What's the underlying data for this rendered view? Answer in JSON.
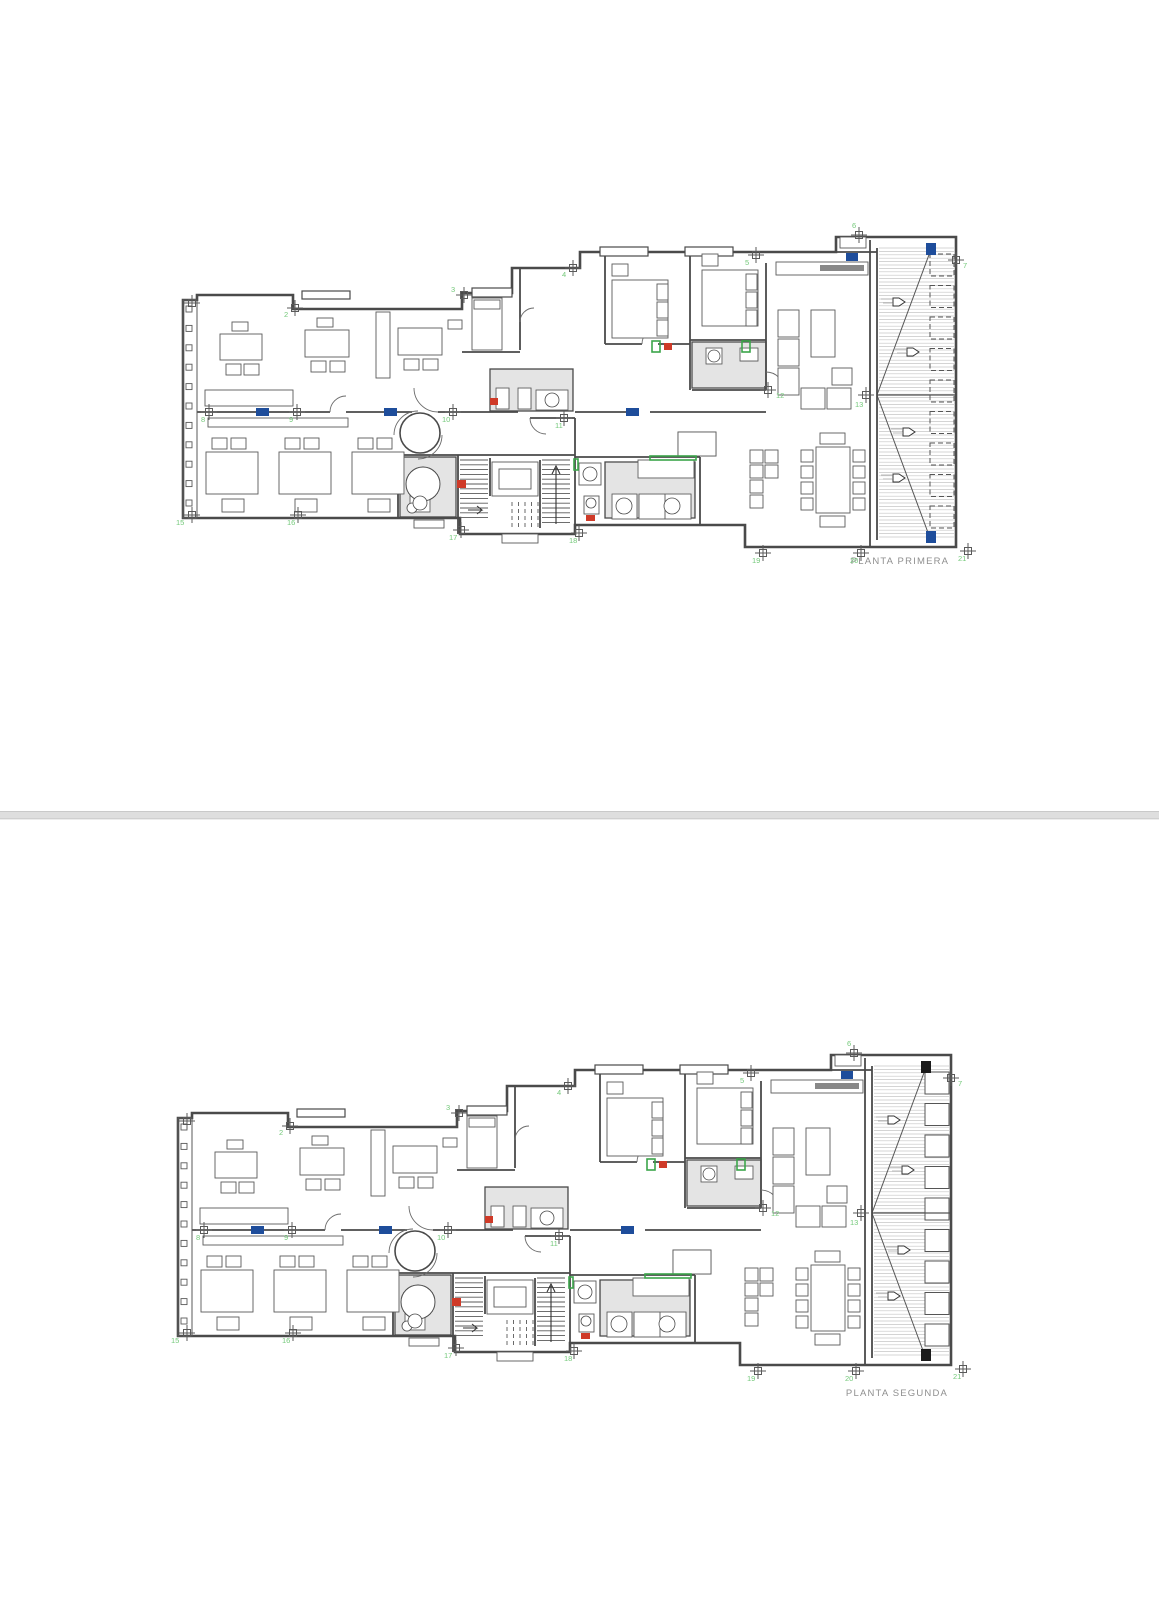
{
  "document": {
    "type": "architectural-floor-plans",
    "sheet_count": 2
  },
  "colors": {
    "wall": "#4a4a4a",
    "thin": "#5a5a5a",
    "marker_green": "#74c97a",
    "accent_blue": "#1e4d9b",
    "accent_red": "#cf3a28",
    "accent_green": "#3ba54a",
    "hatch_line": "#c2c2c2",
    "deck_line": "#c6c6c6",
    "title_gray": "#8f8f8f",
    "page_divider": "#dedede"
  },
  "plans": [
    {
      "id": "primera",
      "title": "PLANTA PRIMERA",
      "terrace_slat_style": "dashed",
      "corner_block_color": "#1e4d9b",
      "markers": [
        {
          "label": "",
          "x": 12,
          "y": 81,
          "lx": 0,
          "ly": 0
        },
        {
          "label": "2",
          "x": 115,
          "y": 86,
          "lx": 104,
          "ly": 95
        },
        {
          "label": "3",
          "x": 284,
          "y": 73,
          "lx": 271,
          "ly": 70
        },
        {
          "label": "4",
          "x": 393,
          "y": 46,
          "lx": 382,
          "ly": 55
        },
        {
          "label": "5",
          "x": 576,
          "y": 33,
          "lx": 565,
          "ly": 43
        },
        {
          "label": "6",
          "x": 679,
          "y": 13,
          "lx": 672,
          "ly": 6
        },
        {
          "label": "7",
          "x": 776,
          "y": 38,
          "lx": 783,
          "ly": 46
        },
        {
          "label": "8",
          "x": 29,
          "y": 190,
          "lx": 21,
          "ly": 200
        },
        {
          "label": "9",
          "x": 117,
          "y": 190,
          "lx": 109,
          "ly": 200
        },
        {
          "label": "10",
          "x": 273,
          "y": 190,
          "lx": 262,
          "ly": 200
        },
        {
          "label": "11",
          "x": 384,
          "y": 196,
          "lx": 375,
          "ly": 206
        },
        {
          "label": "12",
          "x": 588,
          "y": 168,
          "lx": 596,
          "ly": 176
        },
        {
          "label": "13",
          "x": 686,
          "y": 173,
          "lx": 675,
          "ly": 185
        },
        {
          "label": "15",
          "x": 12,
          "y": 293,
          "lx": -4,
          "ly": 303
        },
        {
          "label": "16",
          "x": 118,
          "y": 293,
          "lx": 107,
          "ly": 303
        },
        {
          "label": "17",
          "x": 281,
          "y": 308,
          "lx": 269,
          "ly": 318
        },
        {
          "label": "18",
          "x": 399,
          "y": 311,
          "lx": 389,
          "ly": 321
        },
        {
          "label": "19",
          "x": 583,
          "y": 331,
          "lx": 572,
          "ly": 341
        },
        {
          "label": "20",
          "x": 681,
          "y": 331,
          "lx": 670,
          "ly": 341
        },
        {
          "label": "21",
          "x": 788,
          "y": 329,
          "lx": 778,
          "ly": 339
        }
      ]
    },
    {
      "id": "segunda",
      "title": "PLANTA SEGUNDA",
      "terrace_slat_style": "solid",
      "corner_block_color": "#1b1b1b",
      "markers": [
        {
          "label": "",
          "x": 12,
          "y": 81,
          "lx": 0,
          "ly": 0
        },
        {
          "label": "2",
          "x": 115,
          "y": 86,
          "lx": 104,
          "ly": 95
        },
        {
          "label": "3",
          "x": 284,
          "y": 73,
          "lx": 271,
          "ly": 70
        },
        {
          "label": "4",
          "x": 393,
          "y": 46,
          "lx": 382,
          "ly": 55
        },
        {
          "label": "5",
          "x": 576,
          "y": 33,
          "lx": 565,
          "ly": 43
        },
        {
          "label": "6",
          "x": 679,
          "y": 13,
          "lx": 672,
          "ly": 6
        },
        {
          "label": "7",
          "x": 776,
          "y": 38,
          "lx": 783,
          "ly": 46
        },
        {
          "label": "8",
          "x": 29,
          "y": 190,
          "lx": 21,
          "ly": 200
        },
        {
          "label": "9",
          "x": 117,
          "y": 190,
          "lx": 109,
          "ly": 200
        },
        {
          "label": "10",
          "x": 273,
          "y": 190,
          "lx": 262,
          "ly": 200
        },
        {
          "label": "11",
          "x": 384,
          "y": 196,
          "lx": 375,
          "ly": 206
        },
        {
          "label": "12",
          "x": 588,
          "y": 168,
          "lx": 596,
          "ly": 176
        },
        {
          "label": "13",
          "x": 686,
          "y": 173,
          "lx": 675,
          "ly": 185
        },
        {
          "label": "15",
          "x": 12,
          "y": 293,
          "lx": -4,
          "ly": 303
        },
        {
          "label": "16",
          "x": 118,
          "y": 293,
          "lx": 107,
          "ly": 303
        },
        {
          "label": "17",
          "x": 281,
          "y": 308,
          "lx": 269,
          "ly": 318
        },
        {
          "label": "18",
          "x": 399,
          "y": 311,
          "lx": 389,
          "ly": 321
        },
        {
          "label": "19",
          "x": 583,
          "y": 331,
          "lx": 572,
          "ly": 341
        },
        {
          "label": "20",
          "x": 681,
          "y": 331,
          "lx": 670,
          "ly": 341
        },
        {
          "label": "21",
          "x": 788,
          "y": 329,
          "lx": 778,
          "ly": 339
        }
      ]
    }
  ]
}
